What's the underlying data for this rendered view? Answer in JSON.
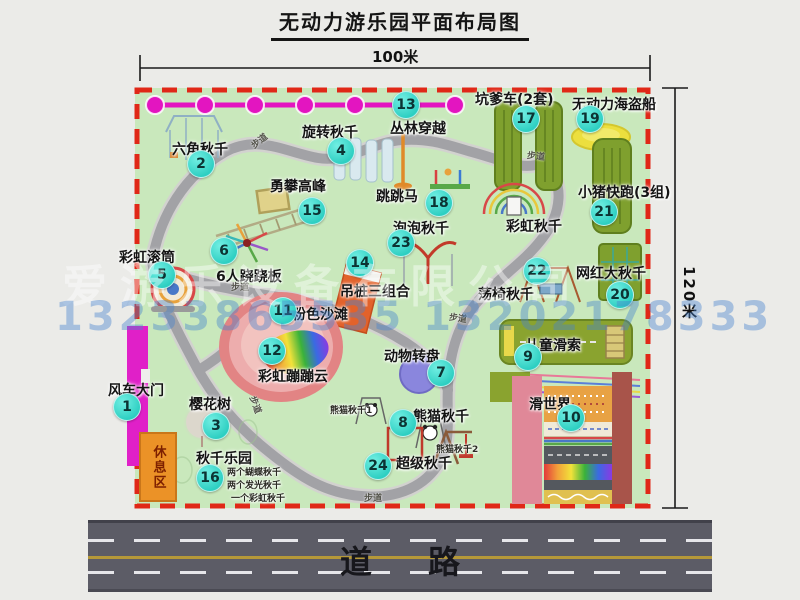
{
  "title": "无动力游乐园平面布局图",
  "dimensions": {
    "width": "100米",
    "height": "120米"
  },
  "road": {
    "label": "道路"
  },
  "watermark": {
    "company": "爱游乐设备有限公司",
    "phone": "13233865535 13202178333"
  },
  "extras": {
    "rainbow_swing_label": "彩虹秋千",
    "walkway_label": "步道",
    "rest_area_label": "休息区"
  },
  "pois": [
    {
      "num": "1",
      "label": "风车大门"
    },
    {
      "num": "2",
      "label": "六角秋千"
    },
    {
      "num": "3",
      "label": "樱花树"
    },
    {
      "num": "4",
      "label": "旋转秋千"
    },
    {
      "num": "5",
      "label": "彩虹滚筒"
    },
    {
      "num": "6",
      "label": "6人跷跷板"
    },
    {
      "num": "7",
      "label": "动物转盘"
    },
    {
      "num": "8",
      "label": "熊猫秋千",
      "notes": [
        "熊猫秋千1",
        "熊猫秋千2"
      ]
    },
    {
      "num": "9",
      "label": "儿童滑索"
    },
    {
      "num": "10",
      "label": "滑世界"
    },
    {
      "num": "11",
      "label": "粉色沙滩"
    },
    {
      "num": "12",
      "label": "彩虹蹦蹦云"
    },
    {
      "num": "13",
      "label": "丛林穿越"
    },
    {
      "num": "14",
      "label": "吊桩三组合"
    },
    {
      "num": "15",
      "label": "勇攀高峰"
    },
    {
      "num": "16",
      "label": "秋千乐园",
      "notes": [
        "两个蝴蝶秋千",
        "两个发光秋千",
        "一个彩虹秋千"
      ]
    },
    {
      "num": "17",
      "label": "坑爹车(2套)"
    },
    {
      "num": "18",
      "label": "跳跳马"
    },
    {
      "num": "19",
      "label": "无动力海盗船"
    },
    {
      "num": "20",
      "label": "网红大秋千"
    },
    {
      "num": "21",
      "label": "小猪快跑(3组)"
    },
    {
      "num": "22",
      "label": "荡椅秋千"
    },
    {
      "num": "23",
      "label": "泡泡秋千"
    },
    {
      "num": "24",
      "label": "超级秋千"
    }
  ],
  "colors": {
    "map_green": "#c9e8bc",
    "border_red": "#e02817",
    "badge_teal": "#35d6c9",
    "gate_magenta": "#e020c8",
    "rest_orange": "#eb9227",
    "road_gray": "#5c5c66",
    "path_gray": "#a2a2a6",
    "zipline_magenta": "#e315c0"
  }
}
